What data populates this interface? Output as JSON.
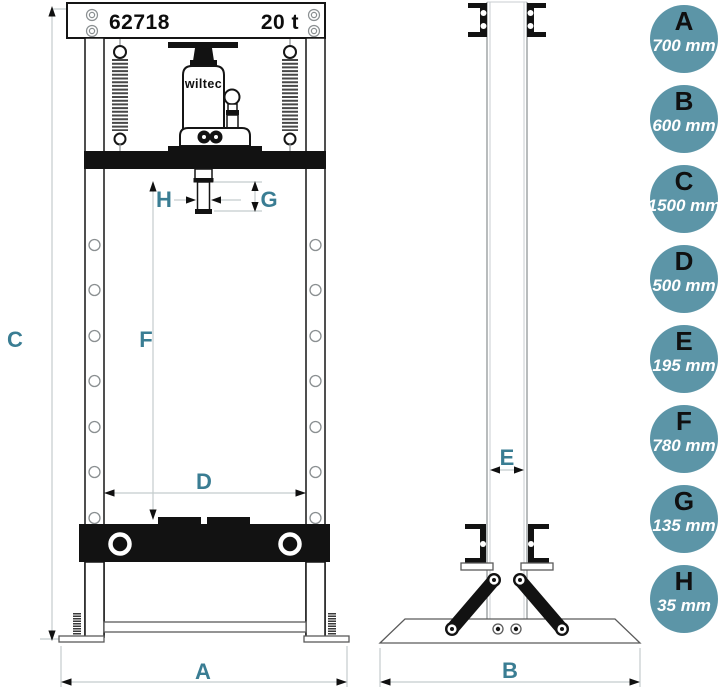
{
  "front_view": {
    "model_number": "62718",
    "capacity": "20 t",
    "brand": "wiltec"
  },
  "dimensions": [
    {
      "letter": "A",
      "value": "700 mm"
    },
    {
      "letter": "B",
      "value": "600 mm"
    },
    {
      "letter": "C",
      "value": "1500 mm"
    },
    {
      "letter": "D",
      "value": "500 mm"
    },
    {
      "letter": "E",
      "value": "195 mm"
    },
    {
      "letter": "F",
      "value": "780 mm"
    },
    {
      "letter": "G",
      "value": "135 mm"
    },
    {
      "letter": "H",
      "value": "35 mm"
    }
  ],
  "colors": {
    "accent_label": "#3a7d93",
    "badge_fill": "#5c95a7",
    "badge_letter": "#101010",
    "badge_value": "#ffffff"
  }
}
